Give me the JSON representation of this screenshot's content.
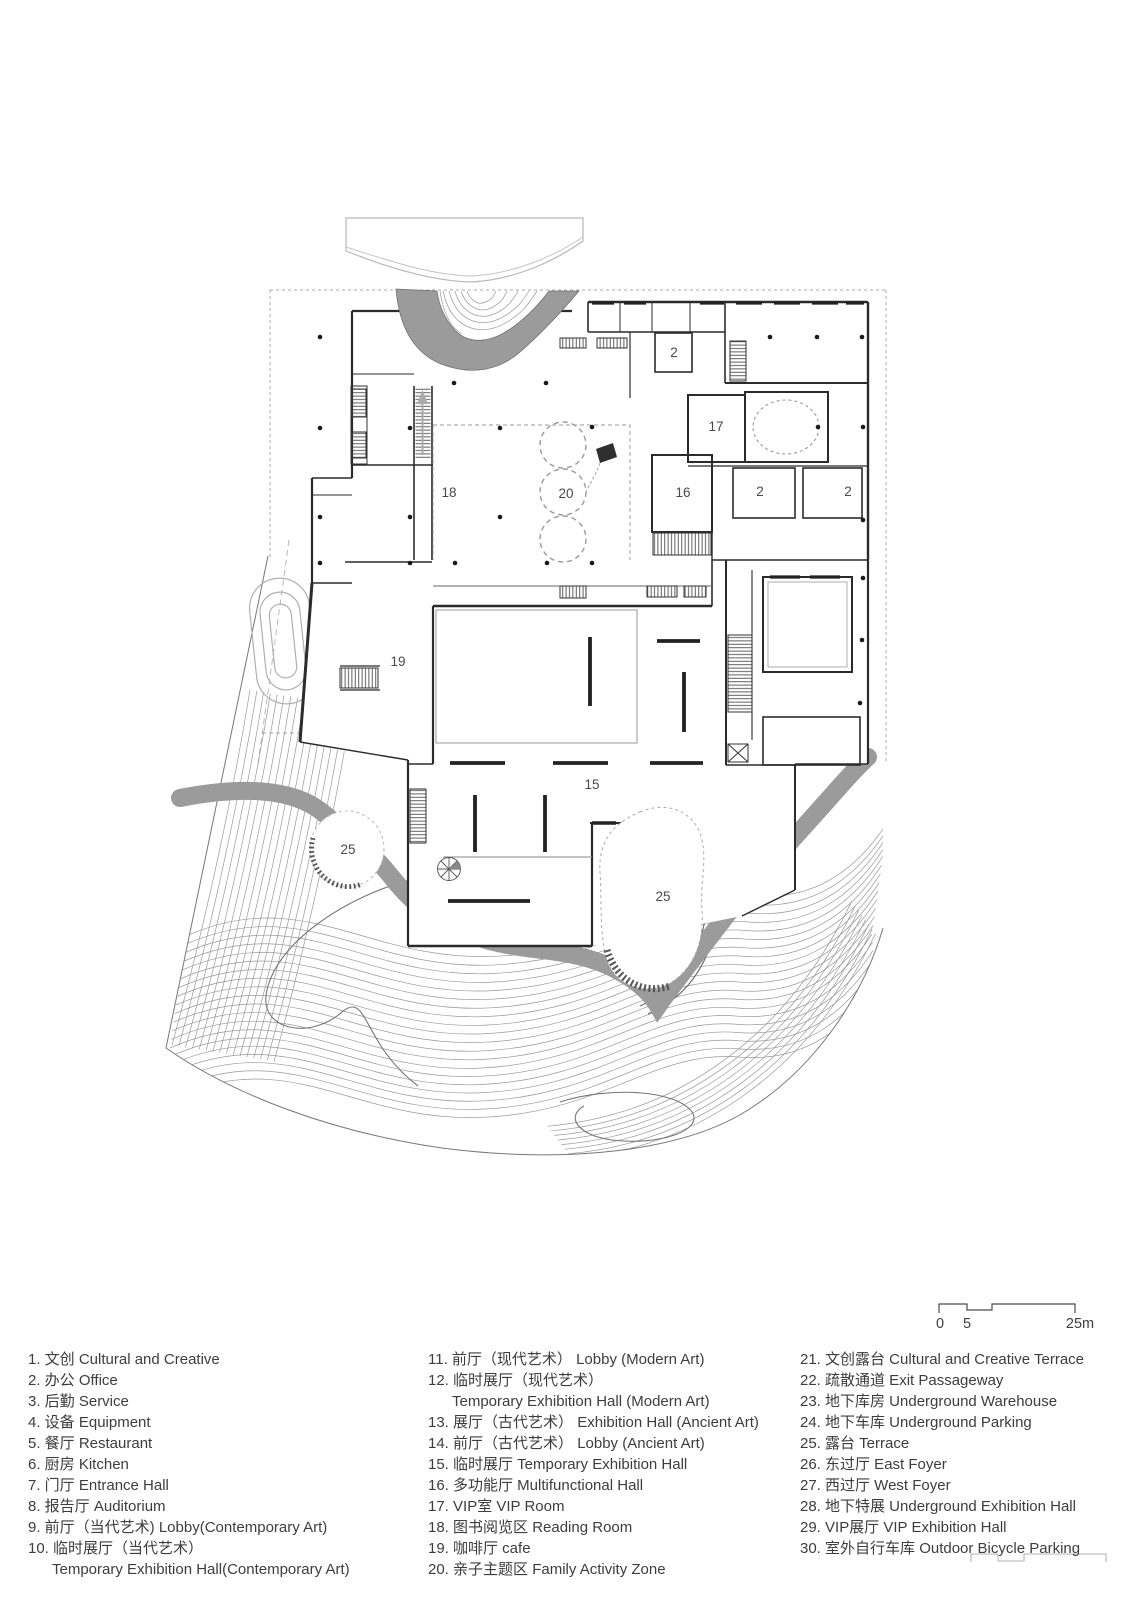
{
  "plan": {
    "rooms": [
      "2",
      "17",
      "18",
      "20",
      "16",
      "2",
      "2",
      "19",
      "15",
      "25",
      "25"
    ]
  },
  "scale_bar": {
    "zero": "0",
    "five": "5",
    "max": "25m"
  },
  "legend": {
    "col1": [
      "1. 文创 Cultural and Creative",
      "2. 办公 Office",
      "3. 后勤 Service",
      "4. 设备 Equipment",
      "5. 餐厅 Restaurant",
      "6. 厨房 Kitchen",
      "7. 门厅 Entrance Hall",
      "8. 报告厅 Auditorium",
      "9. 前厅（当代艺术) Lobby(Contemporary Art)",
      "10. 临时展厅（当代艺术）",
      "Temporary Exhibition Hall(Contemporary Art)"
    ],
    "col2": [
      "11. 前厅（现代艺术） Lobby (Modern Art)",
      "12. 临时展厅（现代艺术）",
      "Temporary Exhibition Hall (Modern Art)",
      "13. 展厅（古代艺术） Exhibition Hall (Ancient Art)",
      "14. 前厅（古代艺术） Lobby (Ancient Art)",
      "15. 临时展厅 Temporary Exhibition Hall",
      "16. 多功能厅 Multifunctional Hall",
      "17. VIP室 VIP Room",
      "18. 图书阅览区 Reading Room",
      "19. 咖啡厅 cafe",
      "20. 亲子主题区 Family Activity Zone"
    ],
    "col3": [
      "21. 文创露台 Cultural and Creative Terrace",
      "22. 疏散通道 Exit Passageway",
      "23. 地下库房 Underground Warehouse",
      "24. 地下车库 Underground Parking",
      "25. 露台 Terrace",
      "26. 东过厅 East Foyer",
      "27. 西过厅 West Foyer",
      "28. 地下特展 Underground Exhibition Hall",
      "29. VIP展厅 VIP Exhibition Hall",
      "30. 室外自行车库 Outdoor Bicycle Parking"
    ]
  }
}
